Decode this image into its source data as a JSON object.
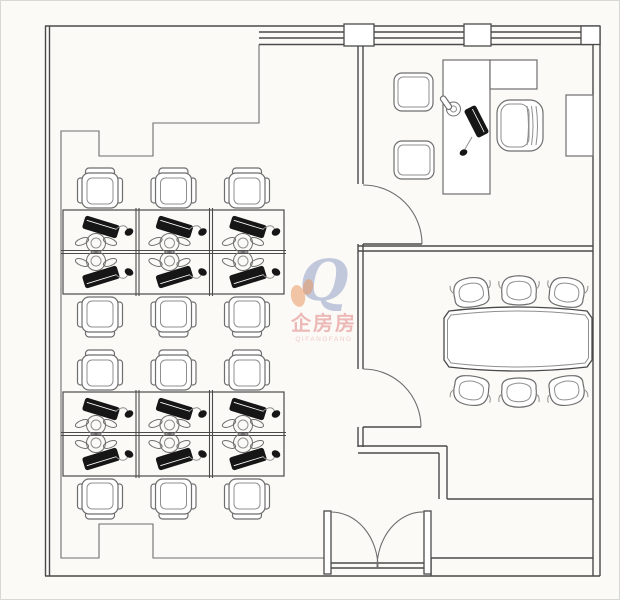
{
  "app": {
    "type": "office-floor-plan",
    "description": "CAD top-view office layout: open-plan workstation area, executive office, conference room, double entry door"
  },
  "colors": {
    "background": "#fbfaf7",
    "frame_border": "#d8d8d4",
    "wall": "#4a4a4a",
    "wall_light": "#6e6e6e",
    "detail": "#8f8f8f",
    "fill": "#ffffff",
    "device_black": "#161616",
    "watermark_blue": "rgba(148,158,198,0.55)",
    "watermark_orange": "rgba(232,152,96,0.55)",
    "watermark_pink": "rgba(222,120,120,0.5)"
  },
  "watermark": {
    "logo_glyph": "Q",
    "title": "企房房",
    "subtitle": "QIFANGFANG"
  },
  "plan": {
    "lines": [
      {
        "n": "wall-top-left",
        "p": [
          44,
          25,
          258,
          25
        ]
      },
      {
        "n": "wall-left-outer",
        "p": [
          44.5,
          25,
          44.5,
          575
        ]
      },
      {
        "n": "wall-left-inner",
        "p": [
          48.5,
          25,
          48.5,
          575
        ]
      },
      {
        "n": "wall-bottom-outer",
        "p": [
          44,
          575,
          599,
          575
        ]
      },
      {
        "n": "wall-right-inner",
        "p": [
          592,
          43.5,
          592,
          575
        ]
      },
      {
        "n": "wall-right-outer",
        "p": [
          599,
          25,
          599,
          575
        ]
      },
      {
        "n": "window-line-1",
        "p": [
          258,
          25,
          599,
          25
        ]
      },
      {
        "n": "window-line-2",
        "p": [
          258,
          31,
          592,
          31
        ]
      },
      {
        "n": "window-line-3",
        "p": [
          258,
          37,
          592,
          37
        ]
      },
      {
        "n": "window-line-4",
        "p": [
          258,
          43.5,
          592,
          43.5
        ]
      },
      {
        "n": "wall-mid-upper-a",
        "p": [
          357,
          43.5,
          357,
          183
        ]
      },
      {
        "n": "wall-mid-upper-b",
        "p": [
          362,
          43.5,
          362,
          183
        ]
      },
      {
        "n": "wall-mid-lower-a",
        "p": [
          357,
          243,
          357,
          368
        ]
      },
      {
        "n": "wall-mid-lower-b",
        "p": [
          362,
          243,
          362,
          368
        ]
      },
      {
        "n": "wall-mid-stub-a",
        "p": [
          357,
          426,
          357,
          446
        ]
      },
      {
        "n": "wall-mid-stub-b",
        "p": [
          362,
          426,
          362,
          446
        ]
      },
      {
        "n": "wall-office-divider-a",
        "p": [
          357,
          245,
          592,
          245
        ]
      },
      {
        "n": "wall-office-divider-b",
        "p": [
          357,
          250,
          592,
          250
        ]
      },
      {
        "n": "wall-conf-bottom-a",
        "p": [
          357,
          445,
          446,
          445
        ]
      },
      {
        "n": "wall-conf-bottom-b",
        "p": [
          357,
          452,
          438,
          452
        ]
      },
      {
        "n": "wall-conf-step-a",
        "p": [
          438,
          452,
          438,
          498
        ]
      },
      {
        "n": "wall-conf-step-b",
        "p": [
          446,
          445,
          446,
          498
        ]
      },
      {
        "n": "wall-conf-bottom-right",
        "p": [
          446,
          498,
          592,
          498
        ]
      },
      {
        "n": "wall-entry-band-top",
        "p": [
          430,
          557,
          592,
          557
        ]
      },
      {
        "n": "wall-entry-band-left",
        "p": [
          430,
          557,
          430,
          575
        ]
      },
      {
        "n": "door-sill-a",
        "p": [
          330,
          562,
          423,
          562
        ]
      },
      {
        "n": "door-sill-b",
        "p": [
          330,
          567,
          423,
          567
        ]
      },
      {
        "n": "door-leaf-office",
        "p": [
          362,
          243,
          421,
          243
        ]
      },
      {
        "n": "door-leaf-conference",
        "p": [
          362,
          426,
          420,
          426
        ]
      },
      {
        "n": "desk-return-diagonal",
        "p": [
          489,
          59,
          536,
          88
        ]
      }
    ],
    "polylines": [
      {
        "n": "zone-boundary",
        "pts": "258,43.5 258,122 152,122 152,155 98,155 98,130 60,130 60,557 98,557 98,523 152,523 152,557 323,557"
      }
    ],
    "blocks": [
      {
        "n": "window-mullion",
        "x": 343,
        "y": 23,
        "w": 30,
        "h": 22
      },
      {
        "n": "window-mullion",
        "x": 463,
        "y": 23,
        "w": 27,
        "h": 22
      },
      {
        "n": "window-corner-block",
        "x": 580,
        "y": 25,
        "w": 19,
        "h": 18.5
      },
      {
        "n": "door-jamb",
        "x": 323,
        "y": 510,
        "w": 7,
        "h": 63
      },
      {
        "n": "door-jamb",
        "x": 423,
        "y": 510,
        "w": 7,
        "h": 63
      }
    ],
    "arcs": [
      {
        "n": "door-arc-office",
        "d": "M 421,243 A 59,59 0 0 0 362,184"
      },
      {
        "n": "door-arc-conference",
        "d": "M 420,426 A 58,58 0 0 0 362,368"
      },
      {
        "n": "door-arc-entry-left",
        "d": "M 330,511 A 47,56 0 0 1 377,567"
      },
      {
        "n": "door-arc-entry-right",
        "d": "M 423,511 A 46,56 0 0 0 376,567"
      }
    ],
    "furnRects": [
      {
        "n": "executive-desk",
        "x": 442,
        "y": 59,
        "w": 47,
        "h": 134
      },
      {
        "n": "executive-desk-return",
        "x": 489,
        "y": 59,
        "w": 47,
        "h": 29
      },
      {
        "n": "cabinet",
        "x": 565,
        "y": 94,
        "w": 27,
        "h": 61
      }
    ],
    "clusters": [
      {
        "n": "desk-cluster-1",
        "x": 62,
        "y": 209,
        "w": 221,
        "h": 84
      },
      {
        "n": "desk-cluster-2",
        "x": 62,
        "y": 391,
        "w": 221,
        "h": 84
      }
    ],
    "cellXs": [
      99,
      172.5,
      246
    ],
    "wsChairRows": [
      {
        "y": 167,
        "flip": false
      },
      {
        "y": 296,
        "flip": true
      },
      {
        "y": 349,
        "flip": false
      },
      {
        "y": 478,
        "flip": true
      }
    ],
    "visitorChairs": [
      {
        "n": "visitor-chair",
        "x": 393,
        "y": 72,
        "w": 39,
        "h": 38
      },
      {
        "n": "visitor-chair",
        "x": 393,
        "y": 140,
        "w": 40,
        "h": 38
      }
    ],
    "execChair": {
      "x": 496,
      "y": 99,
      "w": 46,
      "h": 51
    },
    "confTable": {
      "outer": "M448,310 Q517,302 586,310 L591,317 L591,359 L586,366 Q517,374 448,366 L443,359 L443,317 Z",
      "inner": "M450,314 Q517,306 584,314 L587.5,319 L587.5,357 L584,362 Q517,370 450,362 L446.5,357 L446.5,319 Z"
    },
    "confChairs": [
      {
        "cx": 470,
        "cy": 290,
        "rot": -8
      },
      {
        "cx": 518,
        "cy": 288,
        "rot": 0
      },
      {
        "cx": 566,
        "cy": 290,
        "rot": 8
      },
      {
        "cx": 470,
        "cy": 391,
        "rot": 188
      },
      {
        "cx": 518,
        "cy": 393,
        "rot": 180
      },
      {
        "cx": 566,
        "cy": 391,
        "rot": 172
      }
    ],
    "deskPhone": {
      "cx": 452.5,
      "cy": 108,
      "r1": 7,
      "r2": 3
    },
    "deskLaptop": {
      "cx": 475.5,
      "cy": 120.5,
      "w": 30,
      "h": 12,
      "rot": 63
    },
    "deskMouse": {
      "cx": 462.5,
      "cy": 151.5
    },
    "deskCable": "M 471,136 q -4,7 -7,12"
  }
}
